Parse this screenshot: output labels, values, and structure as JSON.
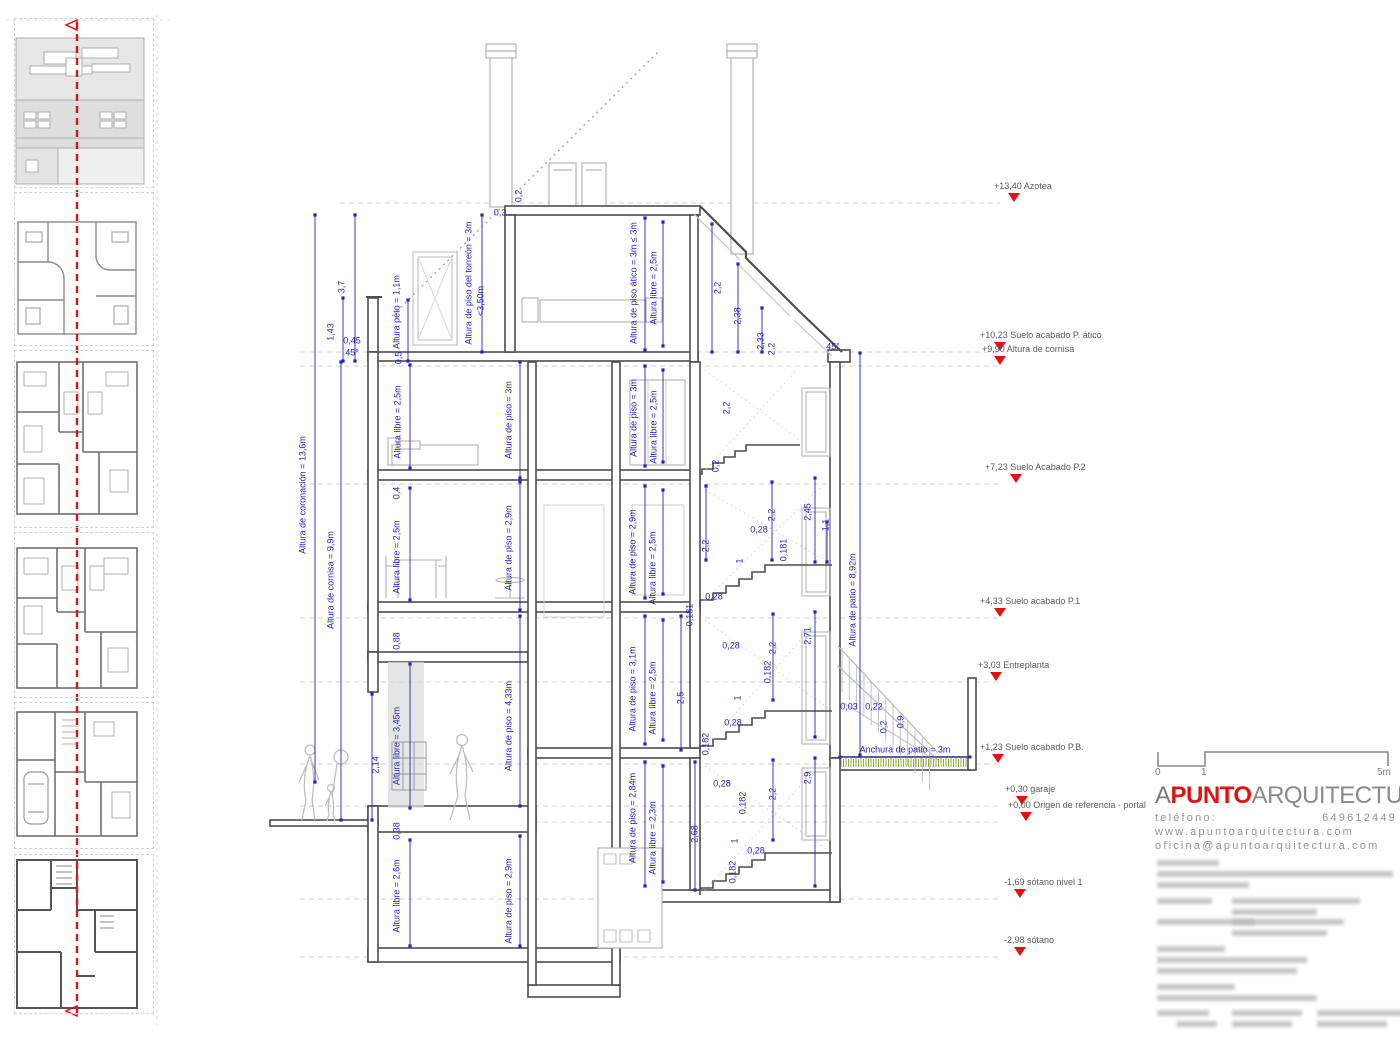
{
  "colors": {
    "dim_blue": "#2323c1",
    "marker_red": "#e01212",
    "wall_dark": "#4d4d4d",
    "line_light": "#b5b5b5",
    "grass_green": "#8fae3f"
  },
  "sidebar": {
    "thumbnail_count": 6
  },
  "levels": [
    {
      "text": "+13,40 Azotea",
      "tx": 994,
      "mx": 1014,
      "line_y": 203,
      "lx": 340
    },
    {
      "text": "+10,23 Suelo acabado P. ático",
      "tx": 980,
      "mx": 1000,
      "line_y": 352,
      "lx": 300
    },
    {
      "text": "+9,90 Altura de cornisa",
      "tx": 982,
      "mx": 1000,
      "line_y": 366,
      "lx": 300
    },
    {
      "text": "+7,23 Suelo Acabado P.2",
      "tx": 985,
      "mx": 1016,
      "line_y": 484,
      "lx": 300
    },
    {
      "text": "+4,33 Suelo acabado P.1",
      "tx": 980,
      "mx": 1000,
      "line_y": 618,
      "lx": 300
    },
    {
      "text": "+3,03 Entreplanta",
      "tx": 978,
      "mx": 996,
      "line_y": 682,
      "lx": 300
    },
    {
      "text": "+1,23 Suelo acabado P.B.",
      "tx": 980,
      "mx": 998,
      "line_y": 764,
      "lx": 300
    },
    {
      "text": "+0,30 garaje",
      "tx": 1005,
      "mx": 1022,
      "line_y": 806,
      "lx": 300
    },
    {
      "text": "+0,00 Origen de referencia - portal",
      "tx": 1008,
      "mx": 1026,
      "line_y": 822,
      "lx": 300
    },
    {
      "text": "-1,69 sótano nivel 1",
      "tx": 1004,
      "mx": 1020,
      "line_y": 899,
      "lx": 300
    },
    {
      "text": "-2,98 sótano",
      "tx": 1004,
      "mx": 1020,
      "line_y": 957,
      "lx": 300
    }
  ],
  "annotations": [
    {
      "t": "3,7",
      "x": 342,
      "y": 287,
      "r": -90
    },
    {
      "t": "1,43",
      "x": 331,
      "y": 332,
      "r": -90
    },
    {
      "t": "0,45",
      "x": 352,
      "y": 341,
      "r": 0
    },
    {
      "t": "45°",
      "x": 352,
      "y": 353,
      "r": 0
    },
    {
      "t": "Altura peto = 1,1m",
      "x": 397,
      "y": 312,
      "r": -90
    },
    {
      "t": "0,5",
      "x": 399,
      "y": 358,
      "r": -90
    },
    {
      "t": "Altura de coronación = 13,6m",
      "x": 303,
      "y": 495,
      "r": -90
    },
    {
      "t": "Altura de cornisa = 9,9m",
      "x": 331,
      "y": 580,
      "r": -90
    },
    {
      "t": "Altura de piso del torreón = 3m",
      "x": 469,
      "y": 283,
      "r": -90
    },
    {
      "t": "<3,50m",
      "x": 481,
      "y": 301,
      "r": -90
    },
    {
      "t": "0,3",
      "x": 500,
      "y": 213,
      "r": 0
    },
    {
      "t": "0,2",
      "x": 519,
      "y": 196,
      "r": -90
    },
    {
      "t": "Altura de piso ático = 3m ≤ 3m",
      "x": 634,
      "y": 283,
      "r": -90
    },
    {
      "t": "Altura libre = 2,5m",
      "x": 654,
      "y": 288,
      "r": -90
    },
    {
      "t": "2,2",
      "x": 718,
      "y": 288,
      "r": -90
    },
    {
      "t": "2,38",
      "x": 738,
      "y": 316,
      "r": -90
    },
    {
      "t": "2,33",
      "x": 761,
      "y": 341,
      "r": -90
    },
    {
      "t": "2,2",
      "x": 772,
      "y": 349,
      "r": -90
    },
    {
      "t": "45°",
      "x": 833,
      "y": 347,
      "r": 0
    },
    {
      "t": "Altura libre = 2,5m",
      "x": 398,
      "y": 422,
      "r": -90
    },
    {
      "t": "Altura de piso = 3m",
      "x": 509,
      "y": 420,
      "r": -90
    },
    {
      "t": "Altura de piso = 3m",
      "x": 634,
      "y": 418,
      "r": -90
    },
    {
      "t": "Altura libre = 2,5m",
      "x": 654,
      "y": 427,
      "r": -90
    },
    {
      "t": "2,2",
      "x": 727,
      "y": 408,
      "r": -90
    },
    {
      "t": "0,2",
      "x": 716,
      "y": 466,
      "r": -90
    },
    {
      "t": "0,4",
      "x": 397,
      "y": 493,
      "r": -90
    },
    {
      "t": "Altura libre = 2,5m",
      "x": 397,
      "y": 557,
      "r": -90
    },
    {
      "t": "Altura de piso = 2,9m",
      "x": 509,
      "y": 548,
      "r": -90
    },
    {
      "t": "Altura de piso = 2,9m",
      "x": 633,
      "y": 552,
      "r": -90
    },
    {
      "t": "Altura libre = 2,5m",
      "x": 653,
      "y": 568,
      "r": -90
    },
    {
      "t": "2,2",
      "x": 706,
      "y": 546,
      "r": -90
    },
    {
      "t": "0,28",
      "x": 759,
      "y": 530,
      "r": 0
    },
    {
      "t": "0,181",
      "x": 784,
      "y": 550,
      "r": -90
    },
    {
      "t": "2,2",
      "x": 772,
      "y": 515,
      "r": -90
    },
    {
      "t": "2,45",
      "x": 808,
      "y": 512,
      "r": -90
    },
    {
      "t": "1,1",
      "x": 826,
      "y": 525,
      "r": -90
    },
    {
      "t": "1",
      "x": 740,
      "y": 561,
      "r": -90
    },
    {
      "t": "0,28",
      "x": 714,
      "y": 597,
      "r": 0
    },
    {
      "t": "0,181",
      "x": 690,
      "y": 615,
      "r": -90
    },
    {
      "t": "Altura de patio = 8,92m",
      "x": 853,
      "y": 600,
      "r": -90
    },
    {
      "t": "0,88",
      "x": 397,
      "y": 641,
      "r": -90
    },
    {
      "t": "Altura de piso = 3,1m",
      "x": 633,
      "y": 689,
      "r": -90
    },
    {
      "t": "Altura libre = 2,5m",
      "x": 653,
      "y": 698,
      "r": -90
    },
    {
      "t": "2,5",
      "x": 681,
      "y": 698,
      "r": -90
    },
    {
      "t": "0,28",
      "x": 731,
      "y": 646,
      "r": 0
    },
    {
      "t": "0,182",
      "x": 768,
      "y": 672,
      "r": -90
    },
    {
      "t": "2,2",
      "x": 773,
      "y": 648,
      "r": -90
    },
    {
      "t": "1",
      "x": 738,
      "y": 698,
      "r": -90
    },
    {
      "t": "0,28",
      "x": 733,
      "y": 723,
      "r": 0
    },
    {
      "t": "0,182",
      "x": 706,
      "y": 744,
      "r": -90
    },
    {
      "t": "2,71",
      "x": 808,
      "y": 636,
      "r": -90
    },
    {
      "t": "0,03",
      "x": 849,
      "y": 707,
      "r": 0
    },
    {
      "t": "0,22",
      "x": 874,
      "y": 707,
      "r": 0
    },
    {
      "t": "0,2",
      "x": 884,
      "y": 727,
      "r": -90
    },
    {
      "t": "0,9",
      "x": 901,
      "y": 722,
      "r": -90
    },
    {
      "t": "2,14",
      "x": 376,
      "y": 765,
      "r": -90
    },
    {
      "t": "Altura libre = 3,45m",
      "x": 397,
      "y": 746,
      "r": -90
    },
    {
      "t": "Altura de piso = 4,33m",
      "x": 509,
      "y": 726,
      "r": -90
    },
    {
      "t": "0,38",
      "x": 397,
      "y": 831,
      "r": -90
    },
    {
      "t": "Altura de piso = 2,84m",
      "x": 633,
      "y": 818,
      "r": -90
    },
    {
      "t": "Altura libre = 2,3m",
      "x": 653,
      "y": 838,
      "r": -90
    },
    {
      "t": "2,68",
      "x": 695,
      "y": 834,
      "r": -90
    },
    {
      "t": "0,28",
      "x": 722,
      "y": 784,
      "r": 0
    },
    {
      "t": "0,182",
      "x": 743,
      "y": 803,
      "r": -90
    },
    {
      "t": "1",
      "x": 735,
      "y": 841,
      "r": -90
    },
    {
      "t": "0,28",
      "x": 756,
      "y": 851,
      "r": 0
    },
    {
      "t": "0,182",
      "x": 733,
      "y": 872,
      "r": -90
    },
    {
      "t": "2,2",
      "x": 773,
      "y": 794,
      "r": -90
    },
    {
      "t": "2,9",
      "x": 808,
      "y": 778,
      "r": -90
    },
    {
      "t": "Anchura de patio = 3m",
      "x": 905,
      "y": 750,
      "r": 0
    },
    {
      "t": "Altura libre = 2,6m",
      "x": 397,
      "y": 896,
      "r": -90
    },
    {
      "t": "Altura de piso = 2,9m",
      "x": 509,
      "y": 901,
      "r": -90
    }
  ],
  "titleblock": {
    "scale_0": "0",
    "scale_1": "1",
    "scale_5": "5m",
    "logo_a": "A",
    "logo_punto": "PUNTO",
    "logo_rest": "ARQUITECTURA",
    "phone_label": "teléfono:",
    "phone_number": "649612449",
    "web": "www.apuntoarquitectura.com",
    "email": "oficina@apuntoarquitectura.com"
  }
}
